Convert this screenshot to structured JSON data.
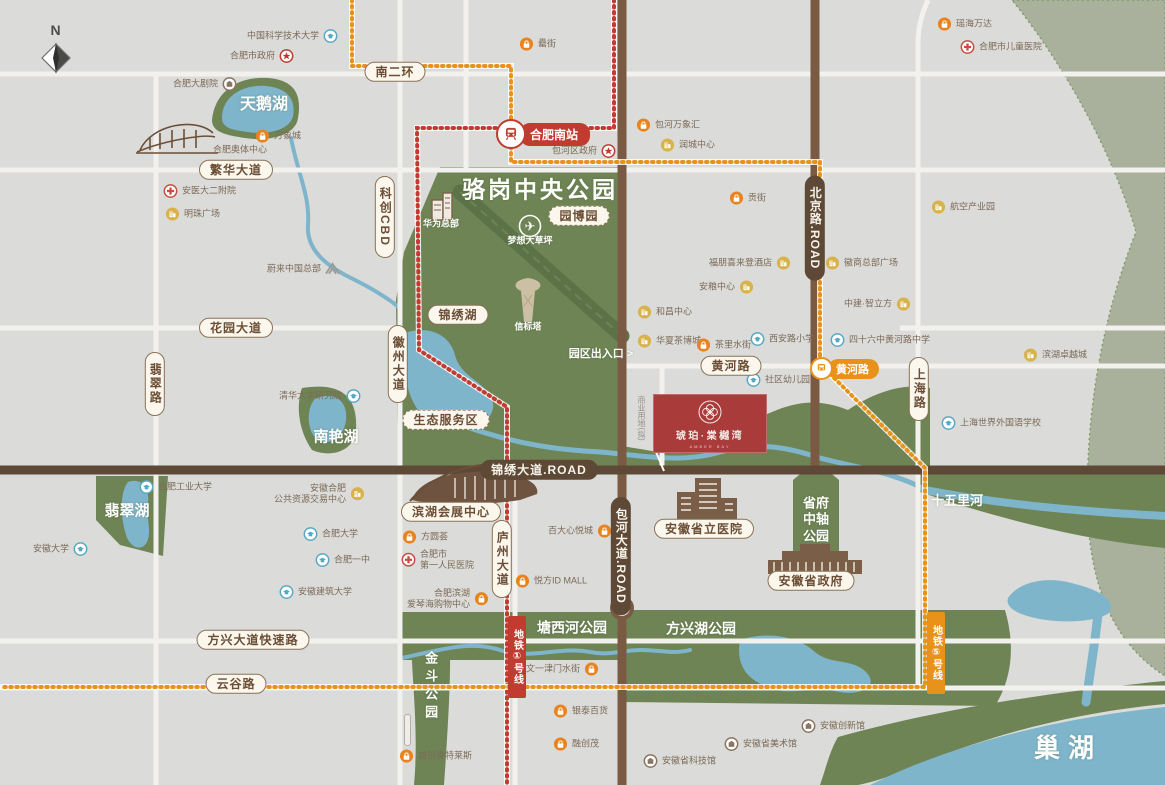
{
  "compass": {
    "label": "N"
  },
  "project": {
    "name": "琥珀·棠樾湾",
    "tagline": "AMBER BAY"
  },
  "stations": {
    "south": {
      "label": "合肥南站"
    },
    "huanghe": {
      "label": "黄河路"
    }
  },
  "metro": {
    "line1": {
      "label": "地铁①号线"
    },
    "line5": {
      "label": "地铁⑤号线"
    }
  },
  "colors": {
    "background": "#DBDBD9",
    "park_green": "#6E8455",
    "sage_green": "#A9B19C",
    "water_blue": "#7EB5CB",
    "road_white": "#F2F1ED",
    "road_brown": "#7A5A42",
    "road_dark_brown": "#5E4836",
    "metro_line1_red": "#C23B30",
    "metro_line5_orange": "#E8921A",
    "badge_cream": "#FBF7ED",
    "project_red": "#A93B3B"
  },
  "road_badges": [
    {
      "label": "南二环",
      "x": 395,
      "y": 72
    },
    {
      "label": "繁华大道",
      "x": 236,
      "y": 170
    },
    {
      "label": "花园大道",
      "x": 236,
      "y": 328
    },
    {
      "label": "翡翠路",
      "x": 155,
      "y": 384,
      "vertical": true
    },
    {
      "label": "科创CBD",
      "x": 385,
      "y": 217,
      "vertical": true
    },
    {
      "label": "徽州大道",
      "x": 398,
      "y": 364,
      "vertical": true
    },
    {
      "label": "锦绣湖",
      "x": 458,
      "y": 315
    },
    {
      "label": "园博园",
      "x": 579,
      "y": 216,
      "variant": "dashed"
    },
    {
      "label": "生态服务区",
      "x": 446,
      "y": 420,
      "variant": "dashed"
    },
    {
      "label": "黄河路",
      "x": 731,
      "y": 366
    },
    {
      "label": "庐州大道",
      "x": 502,
      "y": 559,
      "vertical": true
    },
    {
      "label": "上海路",
      "x": 919,
      "y": 389,
      "vertical": true
    },
    {
      "label": "方兴大道快速路",
      "x": 253,
      "y": 640
    },
    {
      "label": "云谷路",
      "x": 236,
      "y": 684
    },
    {
      "label": "滨湖会展中心",
      "x": 451,
      "y": 512
    },
    {
      "label": "安徽省立医院",
      "x": 704,
      "y": 529
    },
    {
      "label": "安徽省政府",
      "x": 811,
      "y": 581
    },
    {
      "label": "锦绣大道.ROAD",
      "x": 539,
      "y": 470,
      "variant": "dark"
    },
    {
      "label": "北京路.ROAD",
      "x": 815,
      "y": 228,
      "vertical": true,
      "variant": "dark"
    },
    {
      "label": "包河大道.ROAD",
      "x": 621,
      "y": 556,
      "vertical": true,
      "variant": "dark"
    }
  ],
  "area_labels": [
    {
      "text": "骆岗中央公园",
      "x": 540,
      "y": 190,
      "size": 23,
      "spacing": 3
    },
    {
      "text": "天鹅湖",
      "x": 264,
      "y": 105,
      "size": 16
    },
    {
      "text": "翡翠湖",
      "x": 127,
      "y": 512,
      "size": 15
    },
    {
      "text": "南艳湖",
      "x": 336,
      "y": 438,
      "size": 15
    },
    {
      "text": "塘西河公园",
      "x": 572,
      "y": 628,
      "size": 14
    },
    {
      "text": "方兴湖公园",
      "x": 701,
      "y": 629,
      "size": 14
    },
    {
      "text": "十五里河",
      "x": 957,
      "y": 501,
      "size": 13
    },
    {
      "text": "巢湖",
      "x": 1068,
      "y": 748,
      "size": 26,
      "spacing": 8
    },
    {
      "text": "金斗公园",
      "x": 430,
      "y": 687,
      "size": 13,
      "vertical": true,
      "spacing": 5
    },
    {
      "text": "省府中轴公园",
      "x": 816,
      "y": 520,
      "size": 13,
      "wrap": 2
    },
    {
      "text": "华为总部",
      "x": 441,
      "y": 224,
      "size": 9
    },
    {
      "text": "梦想大草坪",
      "x": 530,
      "y": 241,
      "size": 9
    },
    {
      "text": "信标塔",
      "x": 528,
      "y": 327,
      "size": 9
    },
    {
      "text": "园区出入口 >",
      "x": 601,
      "y": 355,
      "size": 11
    },
    {
      "text": "合肥奥体中心",
      "x": 240,
      "y": 150,
      "size": 9,
      "color": "#7B6A57"
    },
    {
      "text": "商业用地(拟)",
      "x": 641,
      "y": 418,
      "size": 8,
      "vertical": true,
      "color": "#97908A"
    }
  ],
  "pois": [
    {
      "label": "中国科学技术大学",
      "x": 330,
      "y": 36,
      "type": "edu",
      "side": "right"
    },
    {
      "label": "合肥市政府",
      "x": 286,
      "y": 56,
      "type": "gov",
      "side": "right"
    },
    {
      "label": "合肥大剧院",
      "x": 229,
      "y": 84,
      "type": "culture",
      "side": "right"
    },
    {
      "label": "万象城",
      "x": 263,
      "y": 136,
      "type": "mall",
      "side": "left"
    },
    {
      "label": "安医大二附院",
      "x": 171,
      "y": 191,
      "type": "hospital",
      "side": "left"
    },
    {
      "label": "明珠广场",
      "x": 173,
      "y": 214,
      "type": "biz",
      "side": "left"
    },
    {
      "label": "蔚来中国总部",
      "x": 332,
      "y": 269,
      "type": "nio",
      "side": "right"
    },
    {
      "label": "清华大学研究院",
      "x": 353,
      "y": 396,
      "type": "edu",
      "side": "right"
    },
    {
      "label": "罍街",
      "x": 527,
      "y": 44,
      "type": "mall",
      "side": "left"
    },
    {
      "label": "包河万象汇",
      "x": 644,
      "y": 125,
      "type": "mall",
      "side": "left"
    },
    {
      "label": "润城中心",
      "x": 668,
      "y": 145,
      "type": "biz",
      "side": "left"
    },
    {
      "label": "包河区政府",
      "x": 608,
      "y": 151,
      "type": "gov",
      "side": "right"
    },
    {
      "label": "瑶海万达",
      "x": 945,
      "y": 24,
      "type": "mall",
      "side": "left"
    },
    {
      "label": "合肥市儿童医院",
      "x": 968,
      "y": 47,
      "type": "hospital",
      "side": "left"
    },
    {
      "label": "航空产业园",
      "x": 939,
      "y": 207,
      "type": "biz",
      "side": "left"
    },
    {
      "label": "贡街",
      "x": 737,
      "y": 198,
      "type": "mall",
      "side": "left"
    },
    {
      "label": "福朋喜来登酒店",
      "x": 783,
      "y": 263,
      "type": "biz",
      "side": "right"
    },
    {
      "label": "徽商总部广场",
      "x": 833,
      "y": 263,
      "type": "biz",
      "side": "left"
    },
    {
      "label": "安粮中心",
      "x": 746,
      "y": 287,
      "type": "biz",
      "side": "right"
    },
    {
      "label": "中建·智立方",
      "x": 903,
      "y": 304,
      "type": "biz",
      "side": "right"
    },
    {
      "label": "和昌中心",
      "x": 645,
      "y": 312,
      "type": "biz",
      "side": "left"
    },
    {
      "label": "华夏茶博城",
      "x": 645,
      "y": 341,
      "type": "biz",
      "side": "left"
    },
    {
      "label": "茶里水街",
      "x": 704,
      "y": 345,
      "type": "mall",
      "side": "left"
    },
    {
      "label": "西安路小学",
      "x": 758,
      "y": 339,
      "type": "edu",
      "side": "left"
    },
    {
      "label": "四十六中黄河路中学",
      "x": 838,
      "y": 340,
      "type": "edu",
      "side": "left"
    },
    {
      "label": "社区幼儿园",
      "x": 754,
      "y": 380,
      "type": "edu",
      "side": "left"
    },
    {
      "label": "滨湖卓越城",
      "x": 1031,
      "y": 355,
      "type": "biz",
      "side": "left"
    },
    {
      "label": "上海世界外国语学校",
      "x": 949,
      "y": 423,
      "type": "edu",
      "side": "left"
    },
    {
      "label": "合肥工业大学",
      "x": 147,
      "y": 487,
      "type": "edu",
      "side": "left"
    },
    {
      "label": "安徽合肥\n公共资源交易中心",
      "x": 357,
      "y": 494,
      "type": "biz",
      "side": "right"
    },
    {
      "label": "安徽大学",
      "x": 80,
      "y": 549,
      "type": "edu",
      "side": "right"
    },
    {
      "label": "合肥大学",
      "x": 311,
      "y": 534,
      "type": "edu",
      "side": "left"
    },
    {
      "label": "合肥一中",
      "x": 323,
      "y": 560,
      "type": "edu",
      "side": "left"
    },
    {
      "label": "安徽建筑大学",
      "x": 287,
      "y": 592,
      "type": "edu",
      "side": "left"
    },
    {
      "label": "方圆荟",
      "x": 410,
      "y": 537,
      "type": "mall",
      "side": "left"
    },
    {
      "label": "合肥市\n第一人民医院",
      "x": 409,
      "y": 560,
      "type": "hospital",
      "side": "left"
    },
    {
      "label": "合肥滨湖\n爱琴海购物中心",
      "x": 481,
      "y": 599,
      "type": "mall",
      "side": "right"
    },
    {
      "label": "百大心悦城",
      "x": 604,
      "y": 531,
      "type": "mall",
      "side": "right"
    },
    {
      "label": "悦方ID MALL",
      "x": 523,
      "y": 581,
      "type": "mall",
      "side": "left"
    },
    {
      "label": "文一津门水街",
      "x": 591,
      "y": 669,
      "type": "mall",
      "side": "right"
    },
    {
      "label": "银泰百货",
      "x": 561,
      "y": 711,
      "type": "mall",
      "side": "left"
    },
    {
      "label": "融创茂",
      "x": 561,
      "y": 744,
      "type": "mall",
      "side": "left"
    },
    {
      "label": "首创奥特莱斯",
      "x": 407,
      "y": 756,
      "type": "mall",
      "side": "left"
    },
    {
      "label": "安徽省科技馆",
      "x": 651,
      "y": 761,
      "type": "culture",
      "side": "left"
    },
    {
      "label": "安徽省美术馆",
      "x": 732,
      "y": 744,
      "type": "culture",
      "side": "left"
    },
    {
      "label": "安徽创新馆",
      "x": 809,
      "y": 726,
      "type": "culture",
      "side": "left"
    }
  ]
}
